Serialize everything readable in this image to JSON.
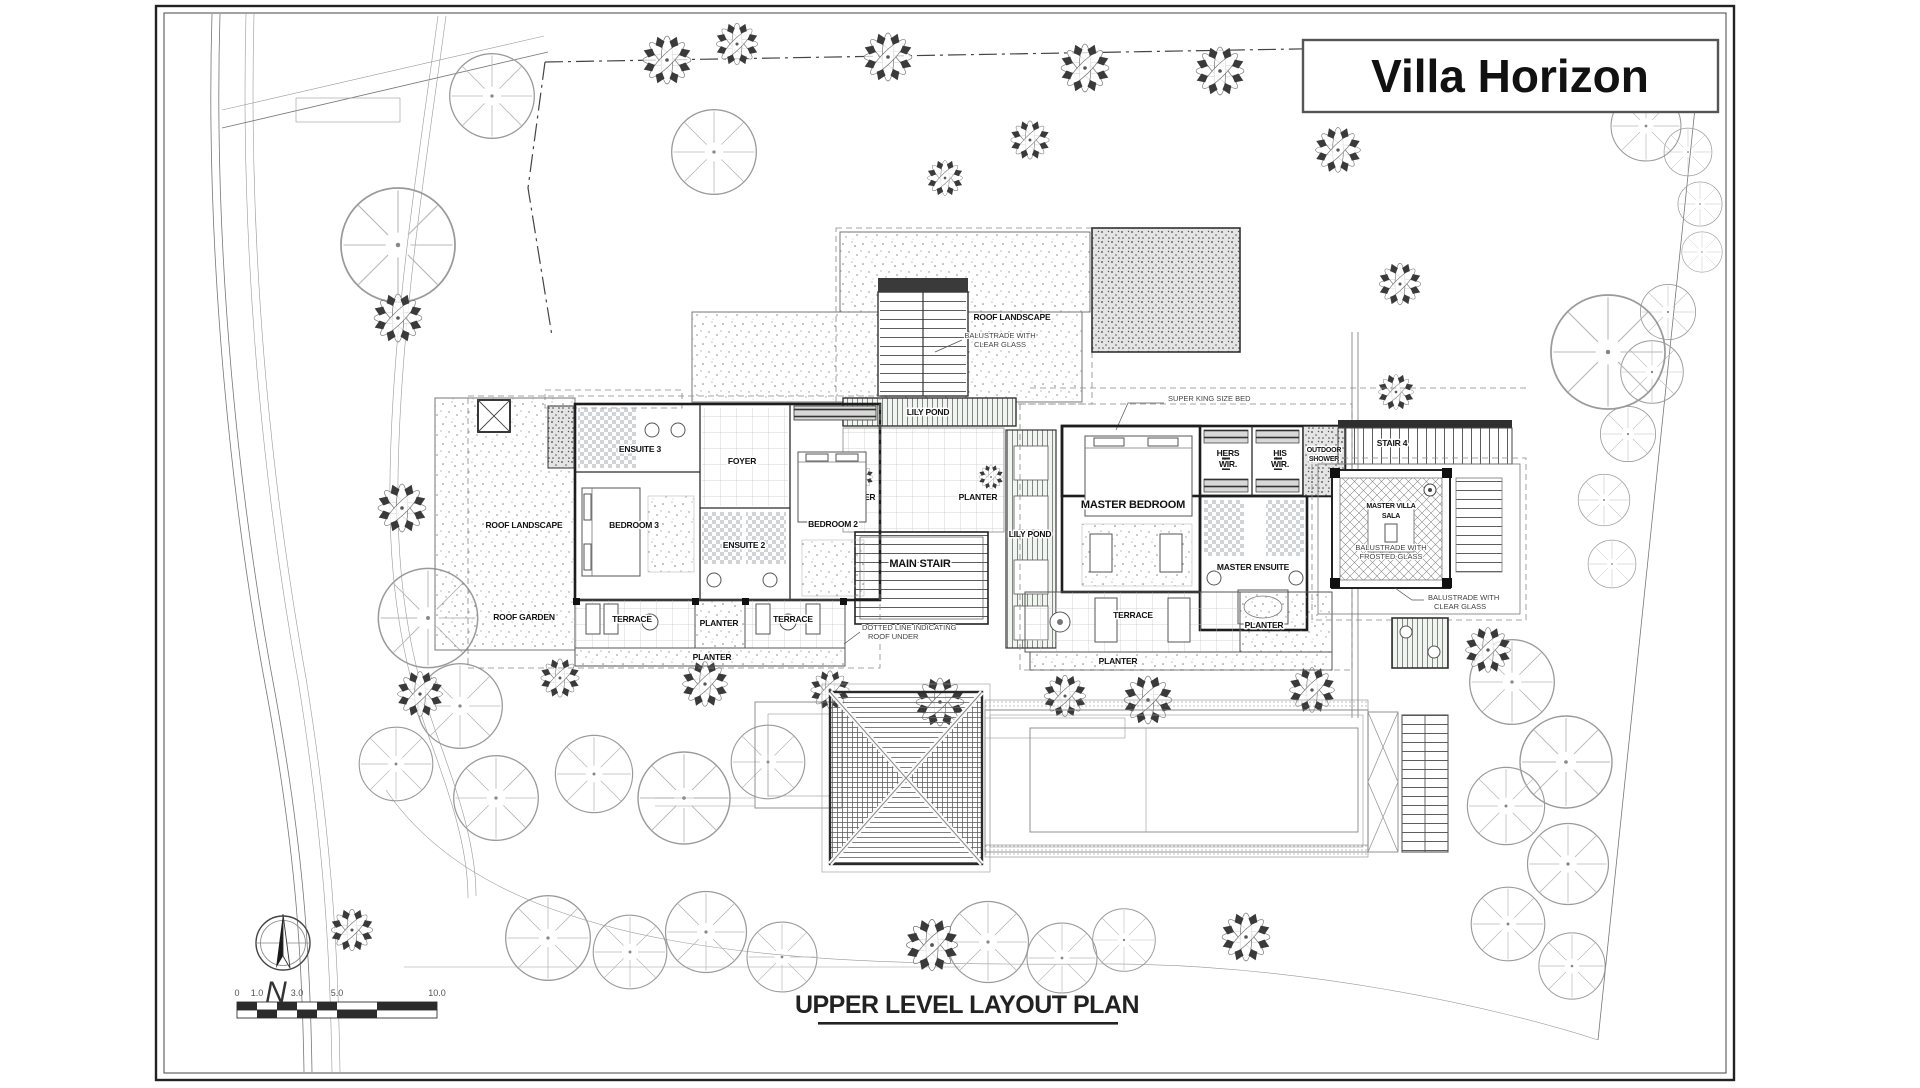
{
  "sheet": {
    "title": "Villa Horizon",
    "plan_title": "UPPER LEVEL LAYOUT PLAN"
  },
  "compass": {
    "north_label": "N"
  },
  "scale_bar": {
    "ticks": [
      "0",
      "1.0",
      "3.0",
      "5.0",
      "10.0"
    ]
  },
  "rooms": {
    "ensuite3": "ENSUITE 3",
    "foyer": "FOYER",
    "bedroom3": "BEDROOM 3",
    "ensuite2": "ENSUITE 2",
    "bedroom2": "BEDROOM 2",
    "main_stair": "MAIN STAIR",
    "master_bedroom": "MASTER BEDROOM",
    "master_ensuite": "MASTER ENSUITE",
    "hers_wir_1": "HERS",
    "hers_wir_2": "WIR.",
    "his_wir_1": "HIS",
    "his_wir_2": "WIR.",
    "outdoor_shower_1": "OUTDOOR",
    "outdoor_shower_2": "SHOWER",
    "stair4": "STAIR 4",
    "sala_1": "MASTER VILLA",
    "sala_2": "SALA"
  },
  "areas": {
    "roof_landscape": "ROOF LANDSCAPE",
    "roof_garden": "ROOF GARDEN",
    "lily_pond": "LILY POND",
    "terrace": "TERRACE",
    "planter": "PLANTER"
  },
  "notes": {
    "super_king_bed": "SUPER KING SIZE BED",
    "balustrade_clear_1": "BALUSTRADE WITH",
    "balustrade_clear_2": "CLEAR GLASS",
    "balustrade_frosted_1": "BALUSTRADE WITH",
    "balustrade_frosted_2": "FROSTED GLASS",
    "roof_under_1": "DOTTED LINE INDICATING",
    "roof_under_2": "ROOF UNDER"
  }
}
